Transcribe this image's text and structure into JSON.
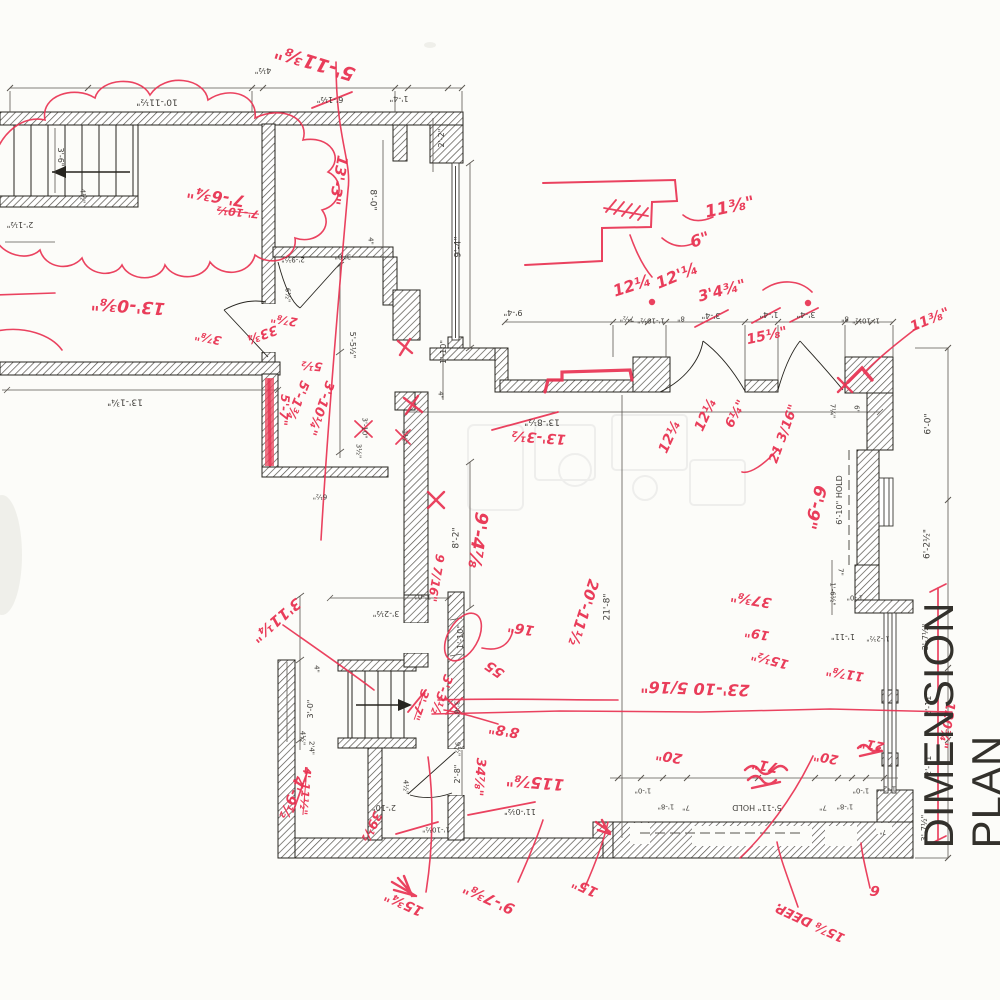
{
  "drawing": {
    "title": "DIMENSION PLAN",
    "colors": {
      "markup_red": "#e93352",
      "wall_ink": "#26241f",
      "paper": "#fcfcf9"
    },
    "printed_dims": {
      "p01": "10'-11½\"",
      "p02": "4½\"",
      "p03": "6'-1½\"",
      "p04": "1'-4\"",
      "p05": "2'-2\"",
      "p06": "9'-4\"",
      "p07": "8'-0\"",
      "p08": "3'-6\"",
      "p09": "4½\"",
      "p10": "2'-1½\"",
      "p11": "2'-9½\"",
      "p12": "3'-0\"",
      "p13": "4\"",
      "p14": "13'-1¾\"",
      "p15": "6½\"",
      "p16": "6½\"",
      "p17": "5'-5½\"",
      "p18": "3½\"",
      "p19": "3'-10\"",
      "p20": "1½\"",
      "p21": "4\"",
      "p22": "1'-10\"",
      "p23": "13'-8½\"",
      "p24": "9'-4\"",
      "p25": "7½\"",
      "p26": "1'-10½\"",
      "p27": "8\"",
      "p28": "3'-4\"",
      "p29": "1'-4\"",
      "p30": "3'-4\"",
      "p31": "8\"",
      "p32": "1'-10½\"",
      "p33": "6'-0\"",
      "p34": "6'-2½\"",
      "p35": "3'-7½\"",
      "p36": "2'-11\"",
      "p37": "2'-11\"",
      "p38": "3'-7½\"",
      "p39": "6'-10\" HOLD",
      "p40": "7\"",
      "p41": "1'-6½\"",
      "p42": "1'-11\"",
      "p43": "1'-2½\"",
      "p44": "1'-0\"",
      "p45": "7¼\"",
      "p46": "6\"",
      "p47": "8'-2\"",
      "p48": "21'-8\"",
      "p49": "1'-10\"",
      "p50": "3'-2½\"",
      "p51": "1'-0\"",
      "p52": "4\"",
      "p53": "3'-0\"",
      "p54": "4½\"",
      "p55": "2'4\"",
      "p56": "2'-10\"",
      "p57": "4½\"",
      "p58": "2'-8\"",
      "p59": "9½\"",
      "p60": "1'-10½\"",
      "p61": "11'-0½\"",
      "p62": "3'-8\"",
      "p63": "1'-0\"",
      "p64": "1'-8\"",
      "p65": "7\"",
      "p66": "5'-11\" HOLD",
      "p67": "7\"",
      "p68": "1'-8\"",
      "p69": "1'-0\"",
      "p70": "1'-2\"",
      "p71": "7\""
    },
    "red_markups": {
      "r01": "5'-11⅜\"",
      "r02": "13'-3\"",
      "r03": "7'-6¾\"",
      "r04": "7'-10½",
      "r05": "3⅞\"",
      "r06": "33¾",
      "r07": "2⅞\"",
      "r08": "13'-0⅜\"",
      "r09": "5½",
      "r10": "5'-1¾",
      "r11": "3'-10¼\"",
      "r12": "5'-7\"",
      "r13": "12¼",
      "r14": "12'¼",
      "r15": "11⅜\"",
      "r16": "6\"",
      "r17": "3'4¾\"",
      "r18": "15⅛\"",
      "r19": "11⅜\"",
      "r20": "12¼",
      "r21": "12¼",
      "r22": "6¼\"",
      "r23": "21 3/16\"",
      "r24": "6'-9\"",
      "r25": "37⅜\"",
      "r26": "19\"",
      "r27": "15½\"",
      "r28": "11⅞\"",
      "r29": "23'-10 5/16\"",
      "r30": "20'-11½",
      "r31": "8'8\"",
      "r32": "115⅞\"",
      "r33": "34⅞\"",
      "r34": "55",
      "r35": "16\"",
      "r36": "9 7/16\"",
      "r37": "9'-4⅞",
      "r38": "3'11¼\"",
      "r39": "3'-7\"",
      "r40": "3'-3½",
      "r41": "39½",
      "r42": "4'-9½",
      "r43": "4'-11½\"",
      "r44": "15¾\"",
      "r45": "9'-7⅜\"",
      "r46": "15\"",
      "r47": "20\"",
      "r48": "71\"",
      "r49": "20\"",
      "r50": "21\"",
      "r51": "120¾\"",
      "r52": "15⅞ DEEP.",
      "r53": "6",
      "r54": "13'-3½"
    }
  }
}
